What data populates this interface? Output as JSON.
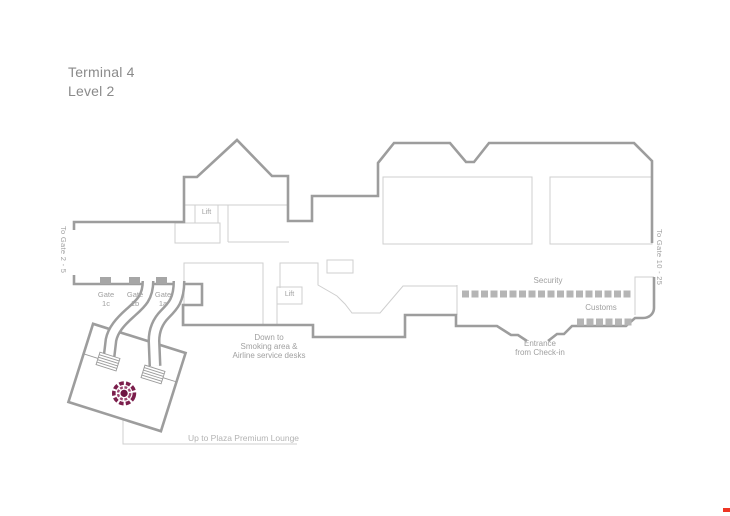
{
  "title": {
    "line1": "Terminal 4",
    "line2": "Level 2"
  },
  "map": {
    "corridor_labels": {
      "left": "To Gate 2 - 5",
      "right": "To Gate 10 - 25"
    },
    "gates": [
      {
        "line1": "Gate",
        "line2": "1c"
      },
      {
        "line1": "Gate",
        "line2": "1b"
      },
      {
        "line1": "Gate",
        "line2": "1a"
      }
    ],
    "lifts": {
      "lift1": "Lift",
      "lift2": "Lift"
    },
    "security": {
      "label": "Security",
      "squares": 18
    },
    "customs": {
      "label": "Customs",
      "squares": 6
    },
    "entrance": {
      "line1": "Entrance",
      "line2": "from Check-in"
    },
    "down_to": {
      "line1": "Down to",
      "line2": "Smoking area &",
      "line3": "Airline service desks"
    },
    "lounge": {
      "callout": "Up to Plaza Premium Lounge",
      "logo": "plaza-premium-lounge-flower-logo"
    },
    "colors": {
      "wall": "#9d9d9d",
      "thin_line": "#cfcfcf",
      "square": "#b5b5b5",
      "gate_square": "#a6a6a6",
      "label_text": "#a0a0a0",
      "title_text": "#8a8a8a",
      "logo_burgundy": "#7b1e4c",
      "logo_burgundy_dark": "#6e1442",
      "logo_pink": "#9c4470",
      "corner_mark_red": "#ee3524"
    }
  }
}
